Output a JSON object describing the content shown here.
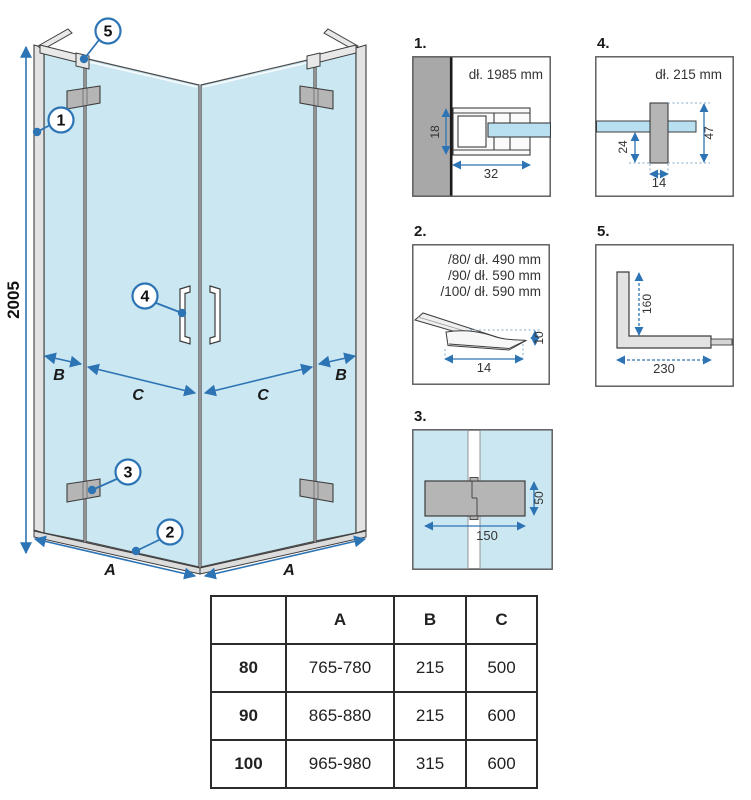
{
  "colors": {
    "glass_blue": "#cbe7f2",
    "accent_blue": "#2d74b5",
    "wall_gray": "#a8a8a8",
    "hardware_gray": "#b5b5b5",
    "profile_gray": "#e3e3e3",
    "line_dark": "#3d3d3d",
    "table_border": "#2b2b2b"
  },
  "main_drawing": {
    "height_label": "2005",
    "dim_a_left": "A",
    "dim_a_right": "A",
    "dim_b_left": "B",
    "dim_b_right": "B",
    "dim_c_left": "C",
    "dim_c_right": "C",
    "callout_1": "1",
    "callout_2": "2",
    "callout_3": "3",
    "callout_4": "4",
    "callout_5": "5"
  },
  "details": {
    "d1": {
      "label": "1.",
      "length": "dł. 1985 mm",
      "dim_depth": "18",
      "dim_width": "32"
    },
    "d2": {
      "label": "2.",
      "line_80": "/80/ dł. 490 mm",
      "line_90": "/90/ dł. 590 mm",
      "line_100": "/100/ dł. 590 mm",
      "dim_width": "14",
      "dim_height": "10"
    },
    "d3": {
      "label": "3.",
      "dim_width": "150",
      "dim_height": "50"
    },
    "d4": {
      "label": "4.",
      "length": "dł. 215 mm",
      "dim_offset": "24",
      "dim_height": "47",
      "dim_width": "14"
    },
    "d5": {
      "label": "5.",
      "dim_vertical": "160",
      "dim_horizontal": "230"
    }
  },
  "size_table": {
    "headers": {
      "col_size": "",
      "col_a": "A",
      "col_b": "B",
      "col_c": "C"
    },
    "rows": [
      {
        "size": "80",
        "a": "765-780",
        "b": "215",
        "c": "500"
      },
      {
        "size": "90",
        "a": "865-880",
        "b": "215",
        "c": "600"
      },
      {
        "size": "100",
        "a": "965-980",
        "b": "315",
        "c": "600"
      }
    ]
  }
}
